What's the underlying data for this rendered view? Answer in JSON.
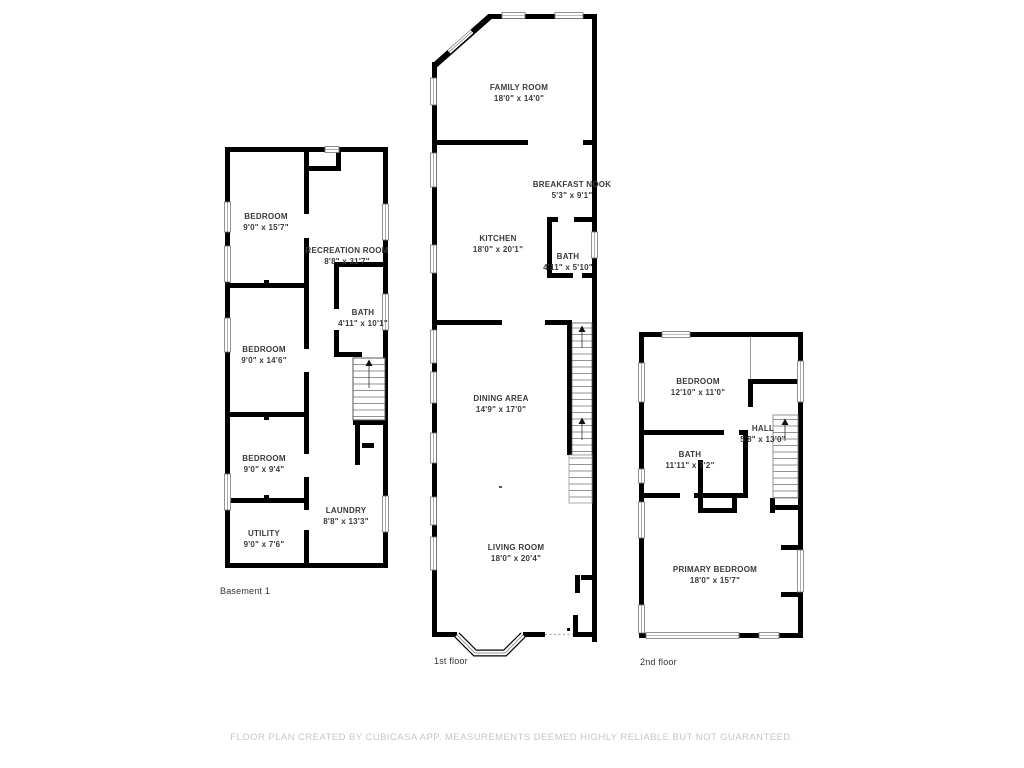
{
  "colors": {
    "wall": "#000000",
    "window_frame": "#777777",
    "stair_line": "#888888",
    "room_text": "#3a3a3a",
    "floor_label_text": "#333333",
    "footer_text": "#c6c6c6",
    "background": "#ffffff"
  },
  "footer": {
    "text": "FLOOR PLAN CREATED BY CUBICASA APP. MEASUREMENTS DEEMED HIGHLY RELIABLE BUT NOT GUARANTEED."
  },
  "floors": [
    {
      "label": "Basement 1",
      "rooms": [
        {
          "name": "BEDROOM",
          "dims": "9'0\" x 15'7\""
        },
        {
          "name": "RECREATION ROOM",
          "dims": "8'8\" x 31'7\""
        },
        {
          "name": "BATH",
          "dims": "4'11\" x 10'1\""
        },
        {
          "name": "BEDROOM",
          "dims": "9'0\" x 14'6\""
        },
        {
          "name": "BEDROOM",
          "dims": "9'0\" x 9'4\""
        },
        {
          "name": "LAUNDRY",
          "dims": "8'8\" x 13'3\""
        },
        {
          "name": "UTILITY",
          "dims": "9'0\" x 7'6\""
        }
      ]
    },
    {
      "label": "1st floor",
      "rooms": [
        {
          "name": "FAMILY ROOM",
          "dims": "18'0\" x 14'0\""
        },
        {
          "name": "BREAKFAST NOOK",
          "dims": "5'3\" x 9'1\""
        },
        {
          "name": "KITCHEN",
          "dims": "18'0\" x 20'1\""
        },
        {
          "name": "BATH",
          "dims": "4'11\" x 5'10\""
        },
        {
          "name": "DINING AREA",
          "dims": "14'9\" x 17'0\""
        },
        {
          "name": "LIVING ROOM",
          "dims": "18'0\" x 20'4\""
        }
      ]
    },
    {
      "label": "2nd floor",
      "rooms": [
        {
          "name": "BEDROOM",
          "dims": "12'10\" x 11'0\""
        },
        {
          "name": "HALL",
          "dims": "5'8\" x 13'0\""
        },
        {
          "name": "BATH",
          "dims": "11'11\" x 7'2\""
        },
        {
          "name": "PRIMARY BEDROOM",
          "dims": "18'0\" x 15'7\""
        }
      ]
    }
  ]
}
